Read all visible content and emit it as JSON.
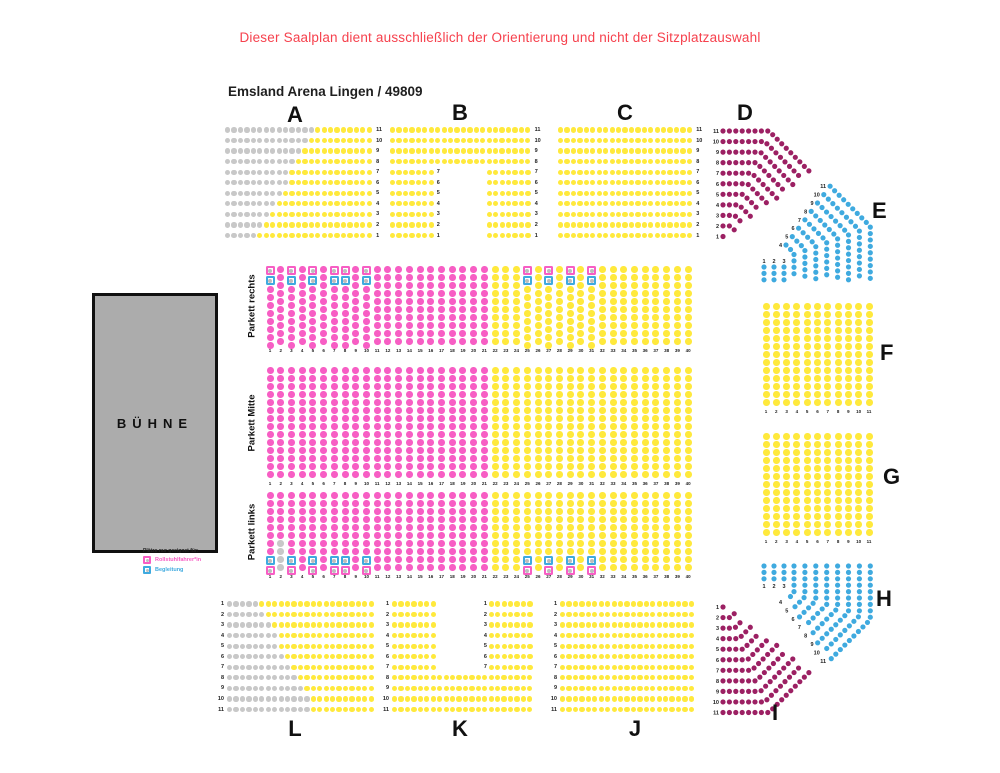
{
  "header": {
    "warning": "Dieser Saalplan dient ausschließlich der Orientierung und nicht der Sitzplatzauswahl",
    "title": "Emsland Arena Lingen / 49809"
  },
  "stage": {
    "label": "BÜHNE"
  },
  "legend": {
    "header": "Plätze nur geeignet für:",
    "items": [
      {
        "label": "Rollstuhlfahrer*in",
        "type": "wheelchair"
      },
      {
        "label": "Begleitung",
        "type": "companion"
      }
    ]
  },
  "colors": {
    "seat_yellow": "#FFE93C",
    "seat_pink": "#F75EC4",
    "seat_gray": "#C8C8C8",
    "seat_maroon": "#9C2063",
    "seat_blue": "#3FAADF",
    "warning_red": "#F6414D",
    "stage_fill": "#ACACAC"
  },
  "stands": {
    "A": {
      "label": "A",
      "rows": [
        {
          "n": "11",
          "p": "g14 y9"
        },
        {
          "n": "10",
          "p": "g13 y10"
        },
        {
          "n": "9",
          "p": "g12 y11"
        },
        {
          "n": "8",
          "p": "g11 y12"
        },
        {
          "n": "7",
          "p": "g10 y13"
        },
        {
          "n": "6",
          "p": "g10 y13"
        },
        {
          "n": "5",
          "p": "g9 y14"
        },
        {
          "n": "4",
          "p": "g8 y15"
        },
        {
          "n": "3",
          "p": "g7 y16"
        },
        {
          "n": "2",
          "p": "g6 y17"
        },
        {
          "n": "1",
          "p": "g5 y18"
        }
      ]
    },
    "B": {
      "label": "B",
      "rows": [
        {
          "n": "11",
          "p": "y22"
        },
        {
          "n": "10",
          "p": "y22"
        },
        {
          "n": "9",
          "p": "y22"
        },
        {
          "n": "8",
          "p": "y22"
        },
        {
          "n": "7",
          "p": "y7 # _7 y7"
        },
        {
          "n": "6",
          "p": "y7 # _7 y7"
        },
        {
          "n": "5",
          "p": "y7 # _7 y7"
        },
        {
          "n": "4",
          "p": "y7 # _7 y7"
        },
        {
          "n": "3",
          "p": "y7 # _7 y7"
        },
        {
          "n": "2",
          "p": "y7 # _7 y7"
        },
        {
          "n": "1",
          "p": "y7 # _7 y7"
        }
      ]
    },
    "C": {
      "label": "C",
      "rows": [
        {
          "n": "11",
          "p": "y21"
        },
        {
          "n": "10",
          "p": "y21"
        },
        {
          "n": "9",
          "p": "y21"
        },
        {
          "n": "8",
          "p": "y21"
        },
        {
          "n": "7",
          "p": "y21"
        },
        {
          "n": "6",
          "p": "y21"
        },
        {
          "n": "5",
          "p": "y21"
        },
        {
          "n": "4",
          "p": "y21"
        },
        {
          "n": "3",
          "p": "y21"
        },
        {
          "n": "2",
          "p": "y21"
        },
        {
          "n": "1",
          "p": "y21"
        }
      ]
    },
    "L": {
      "label": "L",
      "rows": [
        {
          "n": "1",
          "p": "g5 y18"
        },
        {
          "n": "2",
          "p": "g6 y17"
        },
        {
          "n": "3",
          "p": "g7 y16"
        },
        {
          "n": "4",
          "p": "g8 y15"
        },
        {
          "n": "5",
          "p": "g8 y15"
        },
        {
          "n": "6",
          "p": "g9 y14"
        },
        {
          "n": "7",
          "p": "g10 y13"
        },
        {
          "n": "8",
          "p": "g11 y12"
        },
        {
          "n": "9",
          "p": "g12 y11"
        },
        {
          "n": "10",
          "p": "g13 y10"
        },
        {
          "n": "11",
          "p": "g13 y10"
        }
      ]
    },
    "K": {
      "label": "K",
      "rows": [
        {
          "n": "1",
          "p": "y7 _7 # y7"
        },
        {
          "n": "2",
          "p": "y7 _7 # y7"
        },
        {
          "n": "3",
          "p": "y7 _7 # y7"
        },
        {
          "n": "4",
          "p": "y7 _7 # y7"
        },
        {
          "n": "5",
          "p": "y7 _7 # y7"
        },
        {
          "n": "6",
          "p": "y7 _7 # y7"
        },
        {
          "n": "7",
          "p": "y7 _7 # y7"
        },
        {
          "n": "8",
          "p": "y22"
        },
        {
          "n": "9",
          "p": "y22"
        },
        {
          "n": "10",
          "p": "y22"
        },
        {
          "n": "11",
          "p": "y22"
        }
      ]
    },
    "J": {
      "label": "J",
      "rows": [
        {
          "n": "1",
          "p": "y21"
        },
        {
          "n": "2",
          "p": "y21"
        },
        {
          "n": "3",
          "p": "y21"
        },
        {
          "n": "4",
          "p": "y21"
        },
        {
          "n": "5",
          "p": "y21"
        },
        {
          "n": "6",
          "p": "y21"
        },
        {
          "n": "7",
          "p": "y21"
        },
        {
          "n": "8",
          "p": "y21"
        },
        {
          "n": "9",
          "p": "y21"
        },
        {
          "n": "10",
          "p": "y21"
        },
        {
          "n": "11",
          "p": "y21"
        }
      ]
    }
  },
  "side_blocks": {
    "F": {
      "label": "F",
      "seats_per_column": 13,
      "column_numbers": [
        "1",
        "2",
        "3",
        "4",
        "5",
        "6",
        "7",
        "8",
        "9",
        "10",
        "11"
      ]
    },
    "G": {
      "label": "G",
      "seats_per_column": 13,
      "column_numbers": [
        "1",
        "2",
        "3",
        "4",
        "5",
        "6",
        "7",
        "8",
        "9",
        "10",
        "11"
      ]
    }
  },
  "corners": {
    "D": {
      "label": "D",
      "row_numbers": [
        "11",
        "10",
        "9",
        "8",
        "7",
        "6",
        "5",
        "4",
        "3",
        "2",
        "1"
      ]
    },
    "E": {
      "label": "E",
      "row_numbers": [
        "1",
        "2",
        "3",
        "4",
        "5",
        "6",
        "7",
        "8",
        "9",
        "10",
        "11"
      ]
    },
    "H": {
      "label": "H",
      "row_numbers": [
        "1",
        "2",
        "3",
        "4",
        "5",
        "6",
        "7",
        "8",
        "9",
        "10",
        "11"
      ]
    },
    "I": {
      "label": "I",
      "row_numbers": [
        "1",
        "2",
        "3",
        "4",
        "5",
        "6",
        "7",
        "8",
        "9",
        "10",
        "11"
      ]
    }
  },
  "parkett": {
    "column_numbers": [
      "1",
      "2",
      "3",
      "4",
      "5",
      "6",
      "7",
      "8",
      "9",
      "10",
      "11",
      "12",
      "13",
      "14",
      "15",
      "16",
      "17",
      "18",
      "19",
      "20",
      "21",
      "22",
      "23",
      "24",
      "25",
      "26",
      "27",
      "28",
      "29",
      "30",
      "31",
      "32",
      "33",
      "34",
      "35",
      "36",
      "37",
      "38",
      "39",
      "40"
    ],
    "bands": [
      {
        "id": "rechts",
        "label": "Parkett rechts",
        "seats_per_column": 10,
        "pink_columns": 21,
        "total_columns": 40,
        "marker_columns": [
          1,
          3,
          5,
          7,
          8,
          10,
          25,
          27,
          29,
          31
        ],
        "marker_edge": "top",
        "special": []
      },
      {
        "id": "mitte",
        "label": "Parkett Mitte",
        "seats_per_column": 14,
        "pink_columns": 21,
        "total_columns": 40,
        "marker_columns": [],
        "marker_edge": null,
        "special": []
      },
      {
        "id": "links",
        "label": "Parkett links",
        "seats_per_column": 10,
        "pink_columns": 21,
        "total_columns": 40,
        "marker_columns": [
          1,
          3,
          5,
          7,
          8,
          10,
          25,
          27,
          29,
          31
        ],
        "marker_edge": "bottom",
        "special": [
          {
            "column": 2,
            "gray_last": 4
          }
        ]
      }
    ]
  }
}
